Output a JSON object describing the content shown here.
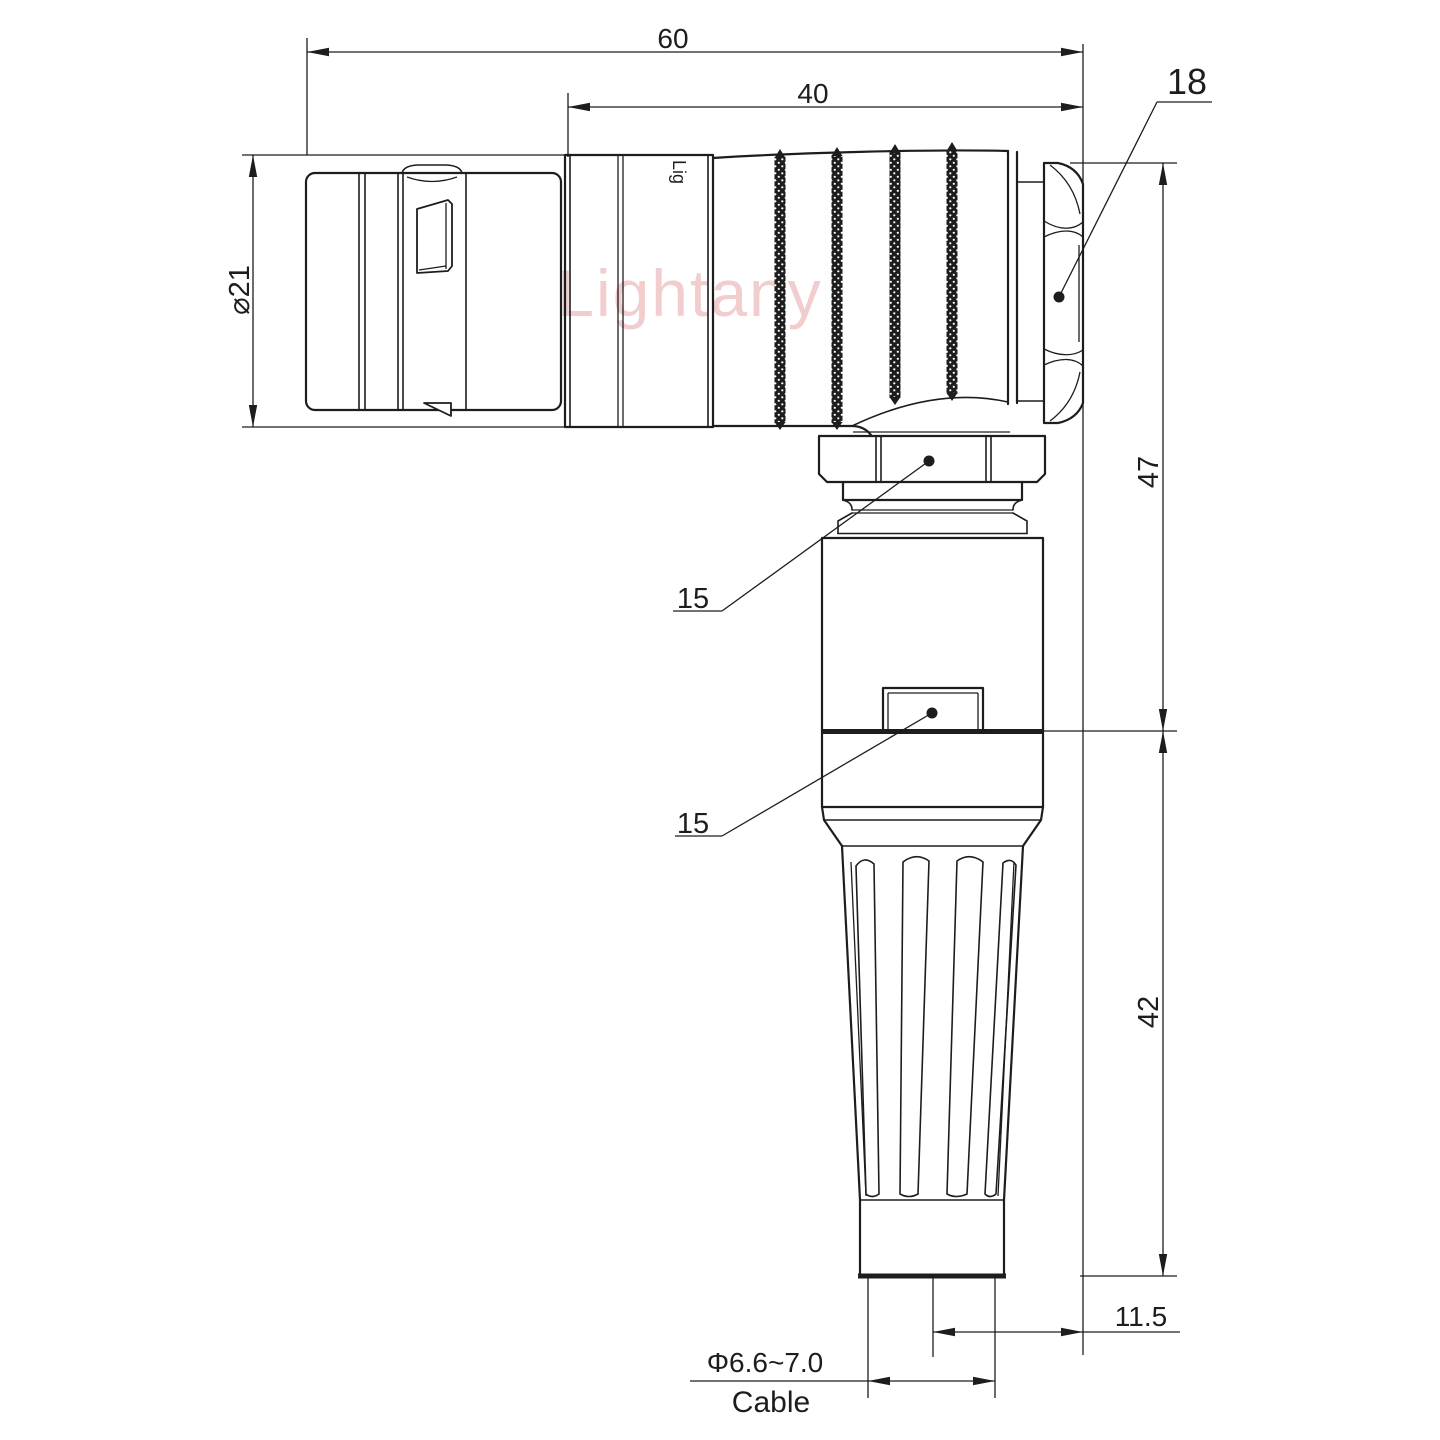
{
  "labels": {
    "overall_length": "60",
    "rear_length": "40",
    "nut_across_flats": "18",
    "shell_diameter": "⌀21",
    "height_to_axis": "47",
    "lower_height": "42",
    "cable_offset": "11.5",
    "cable_diameter": "Φ6.6~7.0",
    "cable": "Cable",
    "coupling_nut_callout": "15",
    "backshell_callout": "15"
  },
  "watermark": {
    "brand_large": "Lightany",
    "engraving": "Lig"
  },
  "colors": {
    "line": "#1d1d1d",
    "watermark_pink": "#efc5c5"
  }
}
